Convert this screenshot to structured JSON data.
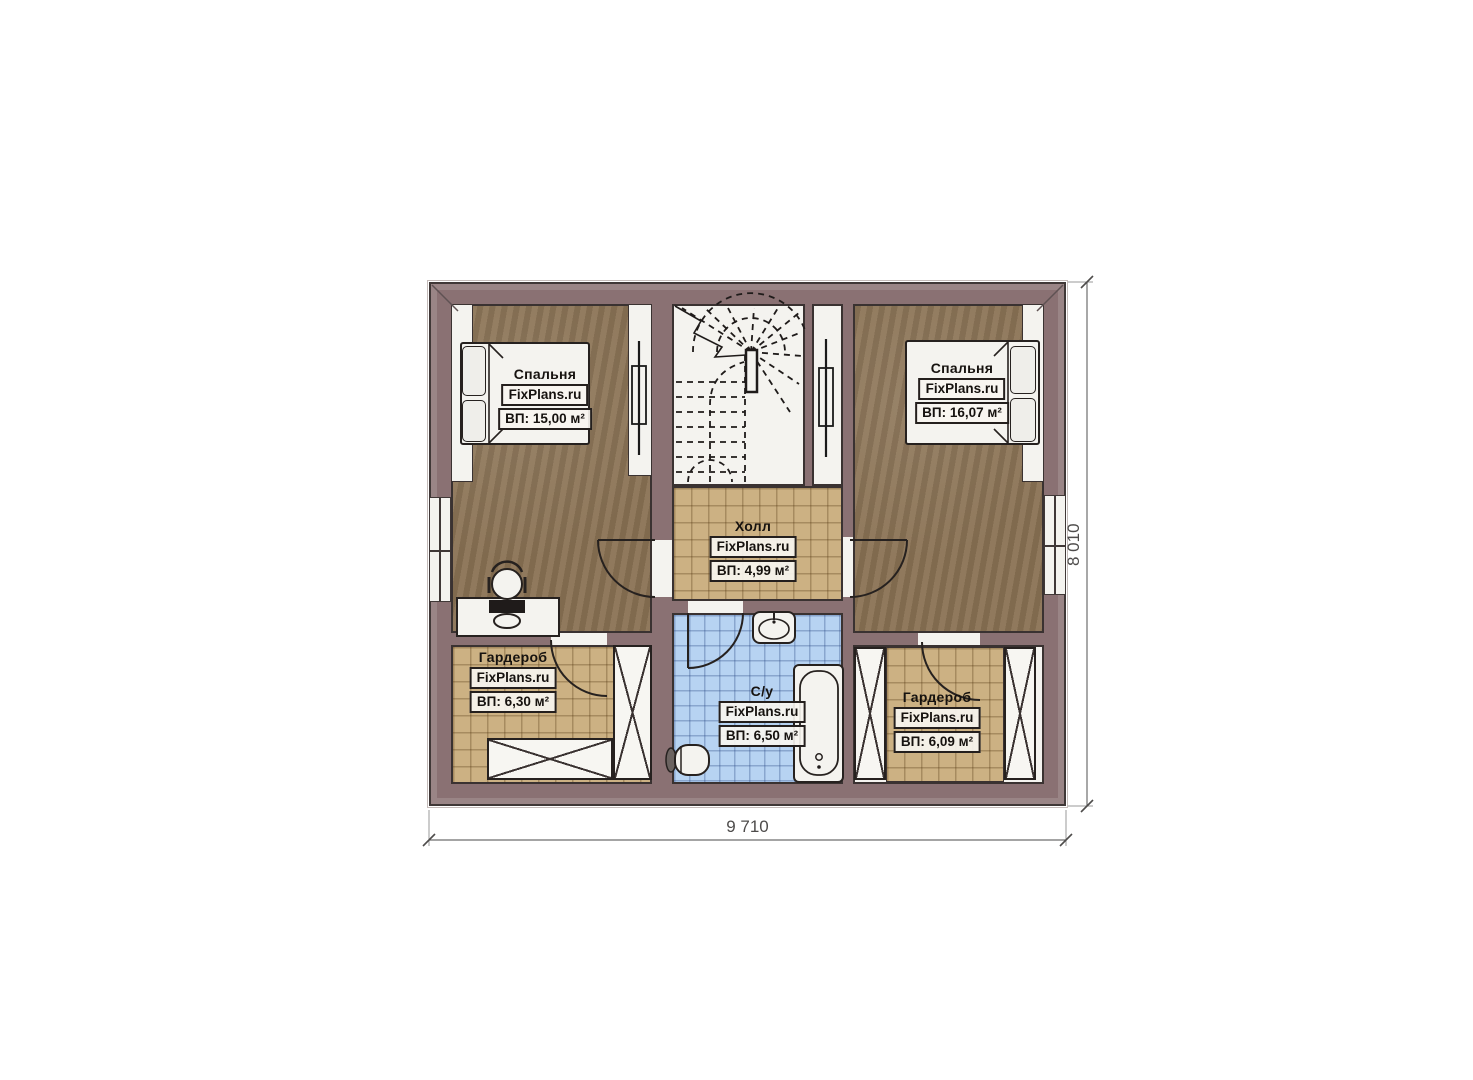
{
  "plan": {
    "title": "attic-floor-plan",
    "dimension_width_label": "9 710",
    "dimension_height_label": "8 010",
    "rooms": [
      {
        "id": "bedroom-left",
        "name": "Спальня",
        "brand": "FixPlans.ru",
        "area": "ВП: 15,00 м²"
      },
      {
        "id": "bedroom-right",
        "name": "Спальня",
        "brand": "FixPlans.ru",
        "area": "ВП: 16,07 м²"
      },
      {
        "id": "hall",
        "name": "Холл",
        "brand": "FixPlans.ru",
        "area": "ВП: 4,99 м²"
      },
      {
        "id": "bathroom",
        "name": "С/у",
        "brand": "FixPlans.ru",
        "area": "ВП: 6,50 м²"
      },
      {
        "id": "wardrobe-left",
        "name": "Гардероб",
        "brand": "FixPlans.ru",
        "area": "ВП: 6,30 м²"
      },
      {
        "id": "wardrobe-right",
        "name": "Гардероб",
        "brand": "FixPlans.ru",
        "area": "ВП: 6,09 м²"
      }
    ],
    "colors": {
      "wall": "#8a7173",
      "floor_wood": "#8a7254",
      "tile_beige": "#ccb183",
      "tile_blue": "#b7d3f2",
      "fixture_white": "#f4f3ef",
      "line": "#26211f"
    }
  }
}
